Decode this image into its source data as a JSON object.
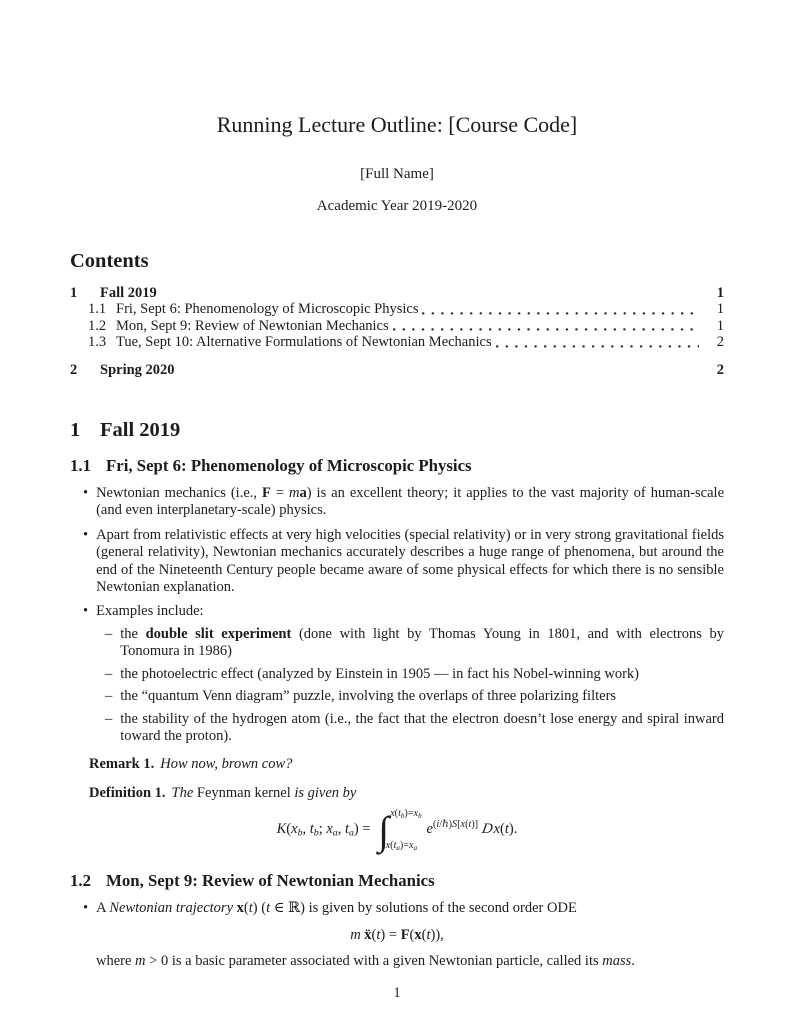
{
  "markers": {
    "bullet": "•",
    "dash": "–"
  },
  "doc": {
    "title": "Running Lecture Outline: [Course Code]",
    "author": "[Full Name]",
    "date": "Academic Year 2019-2020",
    "footer_page_number": "1"
  },
  "toc": {
    "heading": "Contents",
    "entries": [
      {
        "number": "1",
        "title": "Fall 2019",
        "page": "1",
        "level": 1
      },
      {
        "number": "1.1",
        "title": "Fri, Sept 6: Phenomenology of Microscopic Physics",
        "page": "1",
        "level": 2
      },
      {
        "number": "1.2",
        "title": "Mon, Sept 9: Review of Newtonian Mechanics",
        "page": "1",
        "level": 2
      },
      {
        "number": "1.3",
        "title": "Tue, Sept 10: Alternative Formulations of Newtonian Mechanics",
        "page": "2",
        "level": 2
      },
      {
        "number": "2",
        "title": "Spring 2020",
        "page": "2",
        "level": 1
      }
    ]
  },
  "sec1": {
    "number": "1",
    "title": "Fall 2019"
  },
  "sec11": {
    "number": "1.1",
    "title": "Fri, Sept 6: Phenomenology of Microscopic Physics",
    "bullets": {
      "b1": [
        {
          "t": "Newtonian mechanics (i.e., "
        },
        {
          "t": "F",
          "s": "mb"
        },
        {
          "t": " = "
        },
        {
          "t": "m",
          "s": "m"
        },
        {
          "t": "a",
          "s": "mb"
        },
        {
          "t": ") is an excellent theory; it applies to the vast majority of human-scale (and even interplanetary-scale) physics."
        }
      ],
      "b2": [
        {
          "t": "Apart from relativistic effects at very high velocities (special relativity) or in very strong gravitational fields (general relativity), Newtonian mechanics accurately describes a huge range of phenomena, but around the end of the Nineteenth Century people became aware of some physical effects for which there is no sensible Newtonian explanation."
        }
      ],
      "b3": [
        {
          "t": "Examples include:"
        }
      ]
    },
    "examples": [
      [
        {
          "t": "the "
        },
        {
          "t": "double slit experiment",
          "s": "b"
        },
        {
          "t": " (done with light by Thomas Young in 1801, and with electrons by Tonomura in 1986)"
        }
      ],
      [
        {
          "t": "the photoelectric effect (analyzed by Einstein in 1905 — in fact his Nobel-winning work)"
        }
      ],
      [
        {
          "t": "the “quantum Venn diagram” puzzle, involving the overlaps of three polarizing filters"
        }
      ],
      [
        {
          "t": "the stability of the hydrogen atom (i.e., the fact that the electron doesn’t lose energy and spiral inward toward the proton)."
        }
      ]
    ],
    "remark": {
      "label": "Remark 1.",
      "body": [
        {
          "t": "How now, brown cow?",
          "s": "i"
        }
      ]
    },
    "definition": {
      "label": "Definition 1.",
      "body": [
        {
          "t": "The ",
          "s": "i"
        },
        {
          "t": "Feynman kernel"
        },
        {
          "t": " is given by",
          "s": "i"
        }
      ]
    },
    "equation": {
      "lhs": [
        {
          "t": "K",
          "s": "m"
        },
        {
          "t": "("
        },
        {
          "t": "x",
          "s": "m"
        },
        {
          "t": "b",
          "s": "msub"
        },
        {
          "t": ", "
        },
        {
          "t": "t",
          "s": "m"
        },
        {
          "t": "b",
          "s": "msub"
        },
        {
          "t": "; "
        },
        {
          "t": "x",
          "s": "m"
        },
        {
          "t": "a",
          "s": "msub"
        },
        {
          "t": ", "
        },
        {
          "t": "t",
          "s": "m"
        },
        {
          "t": "a",
          "s": "msub"
        },
        {
          "t": ") = "
        }
      ],
      "integral_sign": "∫",
      "upper_limit": [
        {
          "t": "x",
          "s": "m"
        },
        {
          "t": "("
        },
        {
          "t": "t",
          "s": "m"
        },
        {
          "t": "b",
          "s": "msub"
        },
        {
          "t": ")="
        },
        {
          "t": "x",
          "s": "m"
        },
        {
          "t": "b",
          "s": "msub"
        }
      ],
      "lower_limit": [
        {
          "t": "x",
          "s": "m"
        },
        {
          "t": "("
        },
        {
          "t": "t",
          "s": "m"
        },
        {
          "t": "a",
          "s": "msub"
        },
        {
          "t": ")="
        },
        {
          "t": "x",
          "s": "m"
        },
        {
          "t": "a",
          "s": "msub"
        }
      ],
      "exp_base": "e",
      "exponent": [
        {
          "t": "("
        },
        {
          "t": "i",
          "s": "m"
        },
        {
          "t": "/"
        },
        {
          "t": "ℏ"
        },
        {
          "t": ")"
        },
        {
          "t": "S",
          "s": "m"
        },
        {
          "t": "["
        },
        {
          "t": "x",
          "s": "m"
        },
        {
          "t": "("
        },
        {
          "t": "t",
          "s": "m"
        },
        {
          "t": ")]"
        }
      ],
      "tail": [
        {
          "t": "D",
          "s": "scr"
        },
        {
          "t": "x",
          "s": "m"
        },
        {
          "t": "("
        },
        {
          "t": "t",
          "s": "m"
        },
        {
          "t": ")."
        }
      ]
    }
  },
  "sec12": {
    "number": "1.2",
    "title": "Mon, Sept 9: Review of Newtonian Mechanics",
    "bullet": [
      {
        "t": "A "
      },
      {
        "t": "Newtonian trajectory",
        "s": "i"
      },
      {
        "t": " "
      },
      {
        "t": "x",
        "s": "mb"
      },
      {
        "t": "("
      },
      {
        "t": "t",
        "s": "m"
      },
      {
        "t": ") ("
      },
      {
        "t": "t",
        "s": "m"
      },
      {
        "t": " ∈ ℝ"
      },
      {
        "t": ") is given by solutions of the second order ODE"
      }
    ],
    "equation": [
      {
        "t": "m",
        "s": "m"
      },
      {
        "t": " "
      },
      {
        "t": "ẍ",
        "s": "mb"
      },
      {
        "t": "("
      },
      {
        "t": "t",
        "s": "m"
      },
      {
        "t": ") = "
      },
      {
        "t": "F",
        "s": "mb"
      },
      {
        "t": "("
      },
      {
        "t": "x",
        "s": "mb"
      },
      {
        "t": "("
      },
      {
        "t": "t",
        "s": "m"
      },
      {
        "t": ")),"
      }
    ],
    "where": [
      {
        "t": "where "
      },
      {
        "t": "m",
        "s": "m"
      },
      {
        "t": " > 0 is a basic parameter associated with a given Newtonian particle, called its "
      },
      {
        "t": "mass",
        "s": "i"
      },
      {
        "t": "."
      }
    ]
  }
}
